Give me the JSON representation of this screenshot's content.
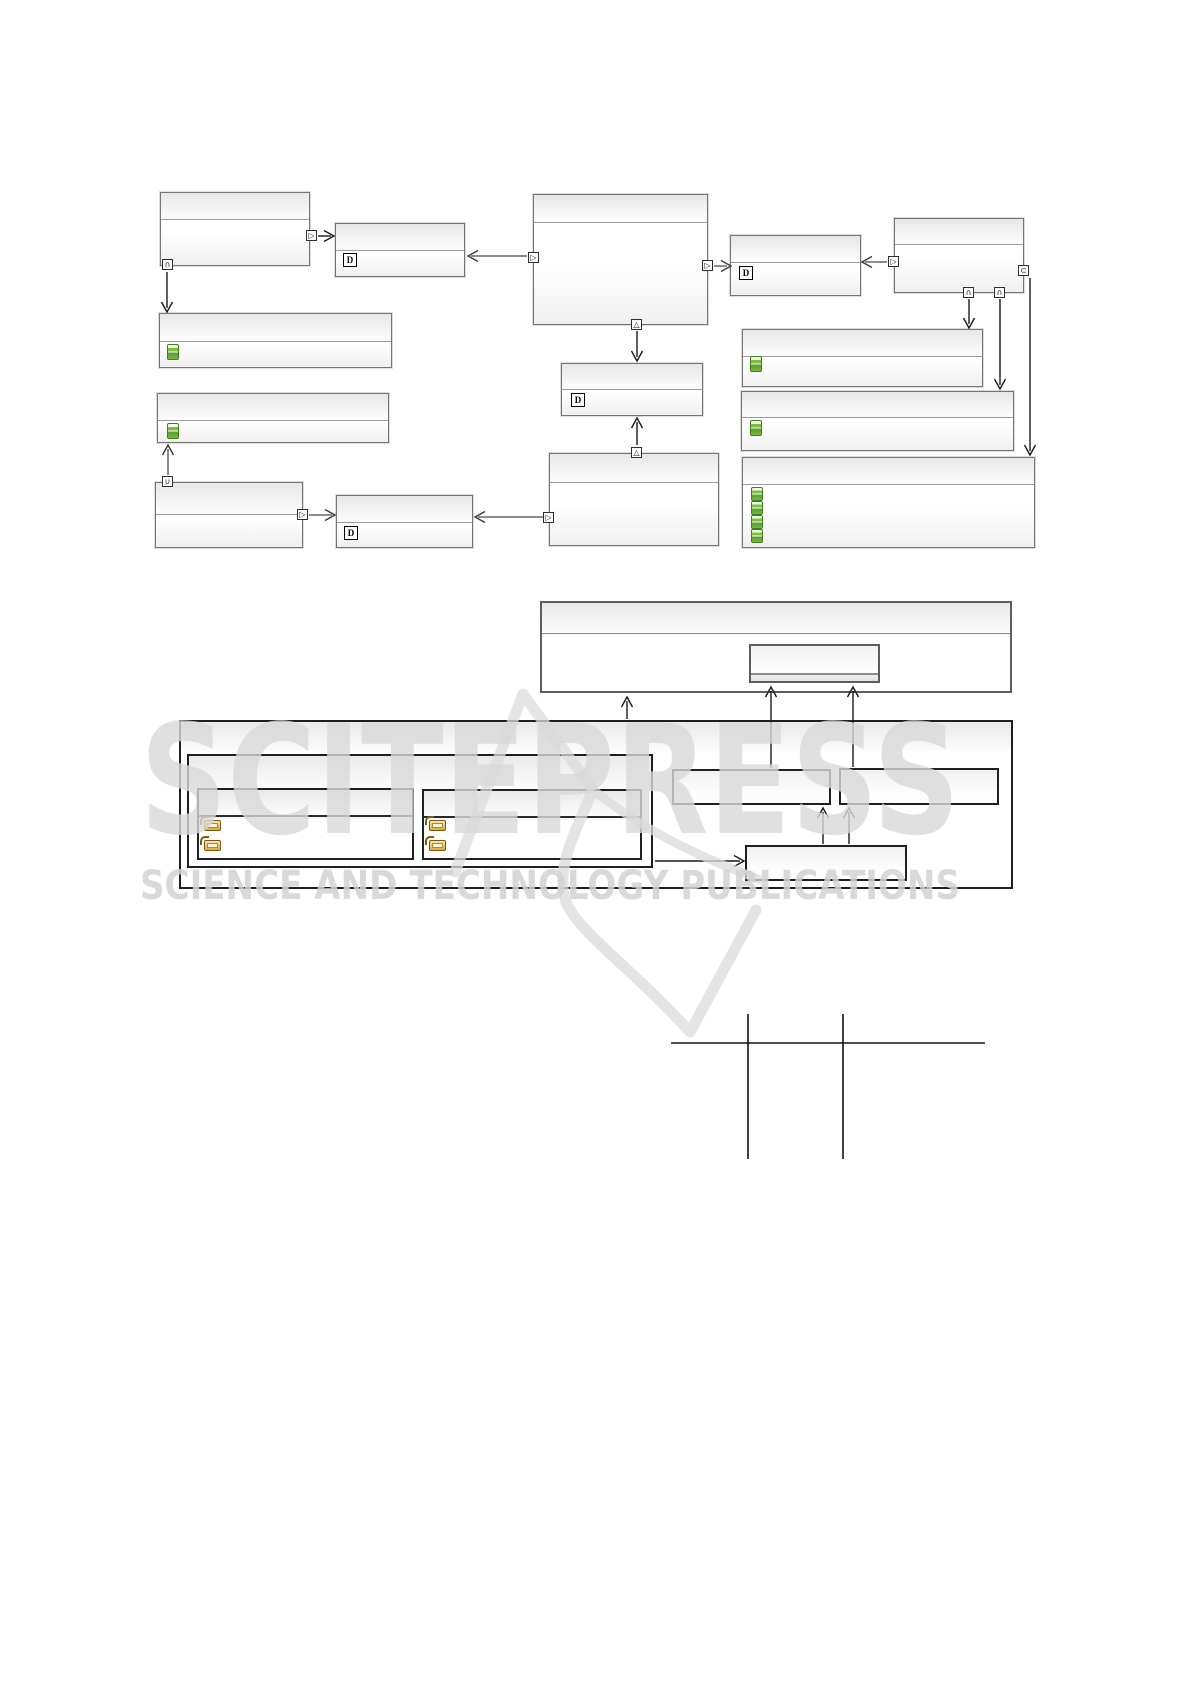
{
  "watermark": {
    "logo_text": "SCITEPRESS",
    "subtitle": "SCIENCE AND TECHNOLOGY PUBLICATIONS",
    "color": "#d9d9d9"
  },
  "glyphs": {
    "out_port": "▷",
    "containment_down": "∩",
    "containment_up": "∪",
    "inheritance": "△",
    "subset": "⊂",
    "datatype": "D"
  },
  "colors": {
    "figure1_box_border": "#757575",
    "figure2_box_border": "#1f1f1f",
    "attribute_icon_green": "#58a12b",
    "reference_icon_gold": "#c9a23c",
    "arrow_gray": "#8c8c8c",
    "arrow_black": "#1a1a1a",
    "table_rule": "#4f4f4f"
  }
}
